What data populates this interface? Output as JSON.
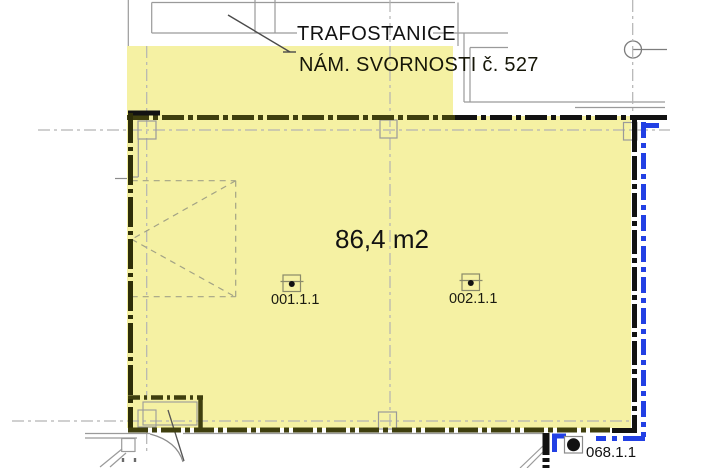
{
  "drawing": {
    "callout": {
      "title": "TRAFOSTANICE",
      "subtitle": "NÁM. SVORNOSTI č. 527"
    },
    "room": {
      "area_label": "86,4 m2",
      "devices": [
        {
          "label": "001.1.1"
        },
        {
          "label": "002.1.1"
        }
      ],
      "adjacent_room_label": "068.1.1"
    },
    "colors": {
      "highlight_yellow": "#f5f1a3",
      "boundary_olive": "#3f3f0e",
      "boundary_black": "#121212",
      "utility_blue": "#2240e4",
      "construction_gray": "#9a9a9a",
      "centerline_gray": "#b3b3b3"
    }
  }
}
